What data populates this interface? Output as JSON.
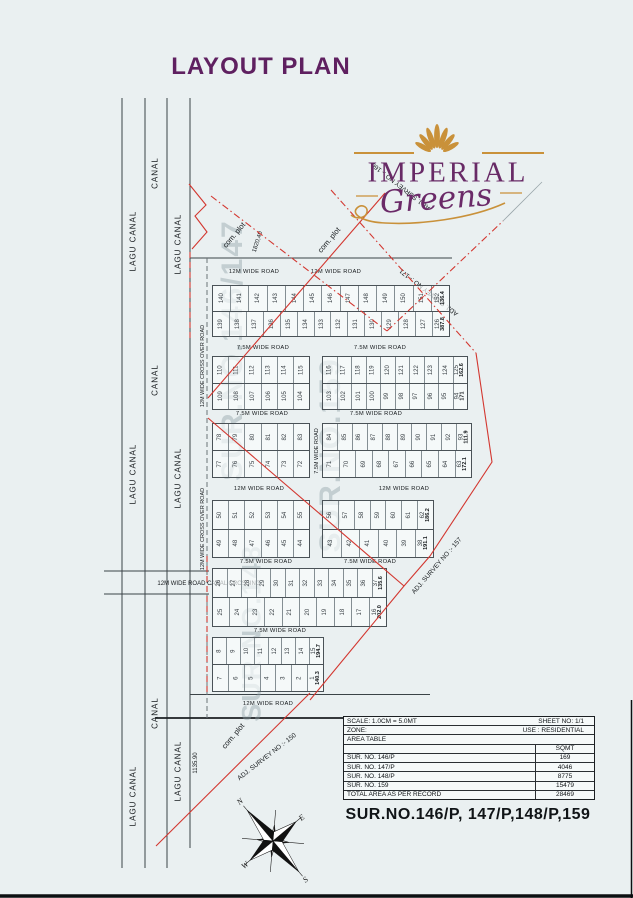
{
  "page": {
    "title": "LAYOUT PLAN",
    "footer_survey": "SUR.NO.146/P, 147/P,148/P,159",
    "bg_color": "#eaf0f1",
    "accent_purple": "#5f2060",
    "boundary_red": "#d33730",
    "logo_gold": "#c9913a"
  },
  "logo": {
    "word": "IMPERIAL",
    "script": "Greens"
  },
  "watermarks": [
    {
      "text": "SUR.NO.146/147",
      "x": 233,
      "y": 350,
      "size": 30
    },
    {
      "text": "SUR.NO.159",
      "x": 331,
      "y": 455,
      "size": 30
    },
    {
      "text": "SUR.NO.148",
      "x": 252,
      "y": 633,
      "size": 27
    }
  ],
  "canal_labels": [
    {
      "text": "CANAL",
      "x": 155,
      "y": 173
    },
    {
      "text": "LAGU CANAL",
      "x": 133,
      "y": 241
    },
    {
      "text": "LAGU CANAL",
      "x": 178,
      "y": 244
    },
    {
      "text": "CANAL",
      "x": 155,
      "y": 380
    },
    {
      "text": "LAGU CANAL",
      "x": 133,
      "y": 474
    },
    {
      "text": "LAGU CANAL",
      "x": 178,
      "y": 478
    },
    {
      "text": "CANAL",
      "x": 155,
      "y": 713
    },
    {
      "text": "LAGU CANAL",
      "x": 133,
      "y": 796
    },
    {
      "text": "LAGU CANAL",
      "x": 178,
      "y": 771
    }
  ],
  "road_labels": [
    {
      "text": "12M WIDE ROAD",
      "x": 254,
      "y": 272
    },
    {
      "text": "12M WIDE ROAD",
      "x": 336,
      "y": 272
    },
    {
      "text": "7.5M WIDE ROAD",
      "x": 263,
      "y": 348
    },
    {
      "text": "7.5M WIDE ROAD",
      "x": 380,
      "y": 348
    },
    {
      "text": "7.5M WIDE ROAD",
      "x": 262,
      "y": 414
    },
    {
      "text": "7.5M WIDE ROAD",
      "x": 376,
      "y": 414
    },
    {
      "text": "12M WIDE ROAD",
      "x": 259,
      "y": 489
    },
    {
      "text": "12M WIDE ROAD",
      "x": 404,
      "y": 489
    },
    {
      "text": "7.5M WIDE ROAD",
      "x": 266,
      "y": 562
    },
    {
      "text": "7.5M WIDE ROAD",
      "x": 370,
      "y": 562
    },
    {
      "text": "7.5M WIDE ROAD",
      "x": 280,
      "y": 631
    },
    {
      "text": "12M WIDE ROAD",
      "x": 268,
      "y": 704
    }
  ],
  "misc_labels": [
    {
      "text": "com. plot",
      "x": 234,
      "y": 235,
      "a": -50,
      "s": 7.5
    },
    {
      "text": "com. plot",
      "x": 329,
      "y": 240,
      "a": -50,
      "s": 7.5
    },
    {
      "text": "com. plot",
      "x": 233,
      "y": 736,
      "a": -50,
      "s": 7.5
    },
    {
      "text": "1820,40",
      "x": 258,
      "y": 242,
      "a": -72,
      "s": 6
    },
    {
      "text": "1135.90",
      "x": 196,
      "y": 763,
      "a": -90,
      "s": 6
    },
    {
      "text": "ADJ. SURVEY NO :- 160",
      "x": 401,
      "y": 186,
      "a": 218,
      "s": 6.5
    },
    {
      "text": "ADJ. SURVEY NO :- 171",
      "x": 429,
      "y": 292,
      "a": 218,
      "s": 6.5
    },
    {
      "text": "ADJ. SURVEY NO :- 157",
      "x": 437,
      "y": 566,
      "a": -49,
      "s": 6.5
    },
    {
      "text": "ADJ. SURVEY NO :- 150",
      "x": 267,
      "y": 757,
      "a": -38,
      "s": 6.5
    },
    {
      "text": "12M WIDE CROSS OVER ROAD",
      "x": 203,
      "y": 366,
      "a": -90,
      "s": 5.5
    },
    {
      "text": "12M WIDE CROSS OVER ROAD",
      "x": 203,
      "y": 529,
      "a": -90,
      "s": 5.5
    },
    {
      "text": "7.5M WIDE ROAD",
      "x": 317,
      "y": 451,
      "a": -90,
      "s": 5.5
    },
    {
      "text": "12M WIDE ROAD CANAL CROSSING",
      "x": 209,
      "y": 584,
      "a": 0,
      "s": 6
    }
  ],
  "blocks": [
    {
      "x": 212,
      "y": 285,
      "w": 238,
      "h": 52,
      "top": [
        "140",
        "141",
        "142",
        "143",
        "144",
        "145",
        "146",
        "147",
        "148",
        "149",
        "150",
        "151",
        "152 136.4"
      ],
      "bottom": [
        "139",
        "138",
        "137",
        "136",
        "135",
        "134",
        "133",
        "132",
        "131",
        "130",
        "129",
        "128",
        "127",
        "126 387.8"
      ]
    },
    {
      "x": 212,
      "y": 356,
      "w": 98,
      "h": 54,
      "top": [
        "110",
        "111",
        "112",
        "113",
        "114",
        "115"
      ],
      "bottom": [
        "109",
        "108",
        "107",
        "106",
        "105",
        "104"
      ]
    },
    {
      "x": 322,
      "y": 356,
      "w": 146,
      "h": 54,
      "top": [
        "116",
        "117",
        "118",
        "119",
        "120",
        "121",
        "122",
        "123",
        "124",
        "125 162.6"
      ],
      "bottom": [
        "103",
        "102",
        "101",
        "100",
        "99",
        "98",
        "97",
        "96",
        "95",
        "94 171"
      ]
    },
    {
      "x": 212,
      "y": 423,
      "w": 98,
      "h": 55,
      "top": [
        "78",
        "79",
        "80",
        "81",
        "82",
        "83"
      ],
      "bottom": [
        "77",
        "76",
        "75",
        "74",
        "73",
        "72"
      ]
    },
    {
      "x": 322,
      "y": 423,
      "w": 150,
      "h": 55,
      "top": [
        "84",
        "85",
        "86",
        "87",
        "88",
        "89",
        "90",
        "91",
        "92",
        "93 111.9"
      ],
      "bottom": [
        "71",
        "70",
        "69",
        "68",
        "67",
        "66",
        "65",
        "64",
        "63 172.1"
      ]
    },
    {
      "x": 212,
      "y": 500,
      "w": 98,
      "h": 58,
      "top": [
        "50",
        "51",
        "52",
        "53",
        "54",
        "55"
      ],
      "bottom": [
        "49",
        "48",
        "47",
        "46",
        "45",
        "44"
      ]
    },
    {
      "x": 322,
      "y": 500,
      "w": 112,
      "h": 58,
      "top": [
        "56",
        "57",
        "58",
        "59",
        "60",
        "61",
        "62 186.2"
      ],
      "bottom": [
        "43",
        "42",
        "41",
        "40",
        "39",
        "38 191.1"
      ]
    },
    {
      "x": 212,
      "y": 568,
      "w": 175,
      "h": 59,
      "top": [
        "26",
        "27",
        "28",
        "29",
        "30",
        "31",
        "32",
        "33",
        "34",
        "35",
        "36",
        "37 135.6"
      ],
      "bottom": [
        "25",
        "24",
        "23",
        "22",
        "21",
        "20",
        "19",
        "18",
        "17",
        "16 202.0"
      ]
    },
    {
      "x": 212,
      "y": 637,
      "w": 112,
      "h": 55,
      "top": [
        "8",
        "9",
        "10",
        "11",
        "12",
        "13",
        "14",
        "15 194.7"
      ],
      "bottom": [
        "7",
        "6",
        "5",
        "4",
        "3",
        "2",
        "1 140.3"
      ]
    }
  ],
  "table": {
    "rows": [
      {
        "type": "free",
        "label": "SCALE: 1.0CM = 5.0MT",
        "value": "SHEET NO: 1/1"
      },
      {
        "type": "free",
        "label": "ZONE:",
        "value": "USE : RESIDENTIAL"
      },
      {
        "type": "full",
        "label": "AREA TABLE",
        "value": ""
      },
      {
        "type": "cols",
        "label": "",
        "value": "SQMT"
      },
      {
        "type": "cols",
        "label": "SUR. NO. 146/P",
        "value": "169"
      },
      {
        "type": "cols",
        "label": "SUR. NO. 147/P",
        "value": "4046"
      },
      {
        "type": "cols",
        "label": "SUR. NO. 148/P",
        "value": "8775"
      },
      {
        "type": "cols",
        "label": "SUR. NO. 159",
        "value": "15479"
      },
      {
        "type": "cols",
        "label": "TOTAL AREA AS PER RECORD",
        "value": "28469"
      }
    ]
  },
  "compass": {
    "n": "N",
    "e": "E",
    "s": "S",
    "w": "W"
  }
}
